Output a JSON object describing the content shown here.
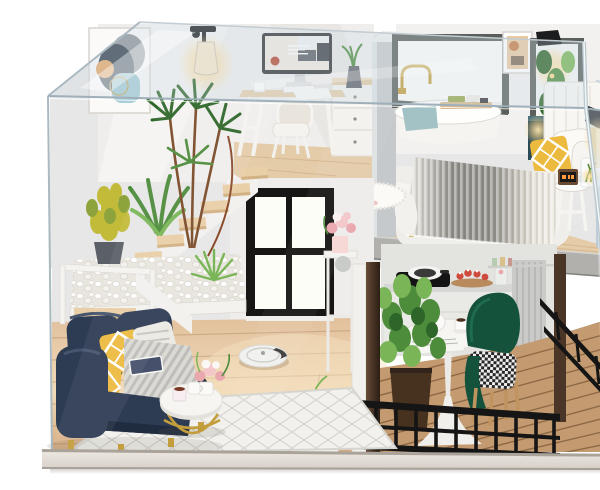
{
  "photo": {
    "alt": "Product photo of a DIY miniature dollhouse loft inside a clear acrylic display case: upstairs study with iMac desk and abstract wall art, bathroom with gold faucet tub, bedroom with grey knit blanket bed; downstairs navy sofa living room, floating stairs with pebble planters, black grid window, robot vacuum, kitchen and a balcony dining set with green velvet chairs behind a black metal railing.",
    "width": 600,
    "height": 458
  },
  "labels": {
    "photo": "dollhouse miniature product photo",
    "display_case": "clear acrylic dust cover display case",
    "base": "wooden display base board",
    "loft_study": "loft study corner with desk, computer and chair",
    "wall_art": "abstract framed wall art",
    "wall_lamp": "glowing glass wall lamp",
    "desk_computer": "desk with iMac style computer, mug, keyboard and drawer unit",
    "bathroom": "bathroom nook with gold faucet, bathtub, towel and caddy tray",
    "bedroom": "bedroom with headboard, pillows and nightstand",
    "bed": "double bed with ombre grey knitted blanket",
    "stairs": "floating wood stairs with white railing and pebble planters",
    "plants": "decorative green plants",
    "living_room": "living room with navy sofa, yellow pillows and coffee table",
    "sofa": "navy blue velvet sofa",
    "coffee_table": "white oval coffee table with gold wire base",
    "window": "black framed four pane window",
    "kitchen": "kitchen counter with cooktop, pan and desserts",
    "dining_set": "round white pedestal table with green velvet chairs",
    "balcony": "wood deck balcony with black metal railing",
    "robot_vacuum": "white robot vacuum on wood floor",
    "glow_lights": "warm miniature LED lights"
  },
  "colors": {
    "bg": "#ffffff",
    "edge": "#a7b6c0",
    "wall": "#f0eeec",
    "wall_cool": "#e8e7e7",
    "wall_shade": "#dcd8d4",
    "pillar": "#c6c9cb",
    "floor_wood": "#e2c19d",
    "floor_hi": "#f0dab8",
    "plank": "#b98e62",
    "loft_wood": "#e4cca9",
    "slab": "#b1b0ad",
    "fascia": "#f5f4f1",
    "win_black": "#171614",
    "pane": "#fdfdf8",
    "bath_frame": "#5a5f5b",
    "gold": "#c49e3d",
    "tub": "#f5f4f0",
    "towel": "#a3c2c5",
    "art_navy": "#333f4d",
    "art_gray": "#8f9298",
    "art_orange": "#e5a868",
    "art_blue": "#a7cdd6",
    "black": "#1b1c1d",
    "glow": "#ffd98f",
    "screen_bg": "#f0e9e0",
    "screen_frame": "#2e3133",
    "sofa": "#2d3b53",
    "sofa_dark": "#1f2b3f",
    "pillow_yellow": "#ecba3e",
    "throw": "#dbd9d4",
    "throw_stripe": "#a8a6a1",
    "rug": "#f2f1ed",
    "rug_line": "#d6d4ce",
    "table_white": "#f6f5f2",
    "chair_green": "#14523c",
    "chair_green_hi": "#1f6b4e",
    "wood_leg": "#c0945f",
    "hound_dark": "#26262a",
    "plant": "#4d8c3b",
    "plant_light": "#7ab657",
    "plant_dark": "#2e6629",
    "plant_yellow": "#c2bb3a",
    "planter": "#46321f",
    "deck": "#c49b70",
    "deck_gap": "#8d6945",
    "rail": "#151515",
    "pebble_bed": "#e9e6e0",
    "stair_wood": "#e9cfa7",
    "stair_side": "#d2b183",
    "bed_white": "#efeeea",
    "blanket_gray": "#8e8c86",
    "teal_cab": "#2a4a55",
    "mirror": "#bccbd5",
    "vacuum": "#f1f1ef",
    "base_face": "#d7d0c8",
    "base_hi": "#ebe6df",
    "base_line": "#aaa39a",
    "flower_pink": "#e9a8ae",
    "red": "#cf4a3c",
    "walnut": "#4a3526"
  }
}
